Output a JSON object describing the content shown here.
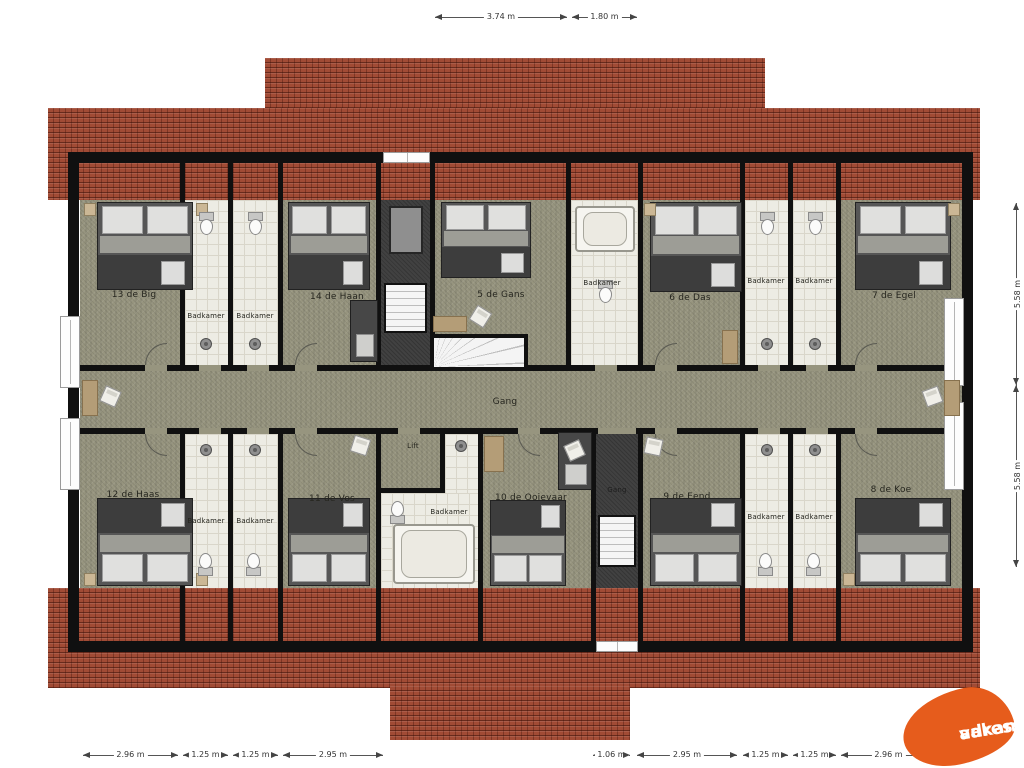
{
  "dims": {
    "top": [
      "3.74 m",
      "1.80 m"
    ],
    "right": [
      "5.58 m",
      "5.58 m"
    ],
    "bottom": [
      "2.96 m",
      "1.25 m",
      "1.25 m",
      "2.95 m",
      "1.06 m",
      "2.95 m",
      "1.25 m",
      "1.25 m",
      "2.96 m"
    ]
  },
  "rooms": {
    "r13": "13 de Big",
    "r14": "14 de Haan",
    "r5": "5 de Gans",
    "r6": "6 de Das",
    "r7": "7 de Egel",
    "r12": "12 de Haas",
    "r11": "11 de Vos",
    "r10": "10 de Ooievaar",
    "r9": "9 de Eend",
    "r8": "8 de Koe",
    "badkamer": "Badkamer",
    "gang": "Gang",
    "lift": "Lift"
  },
  "logo": {
    "line1": "vakantie",
    "line2": "adressen",
    "color": "#e65c1c"
  },
  "colors": {
    "roof": "#a14b35",
    "floor": "#97957f",
    "bathroom": "#edece4",
    "wall": "#101010",
    "shaft": "#414141"
  }
}
